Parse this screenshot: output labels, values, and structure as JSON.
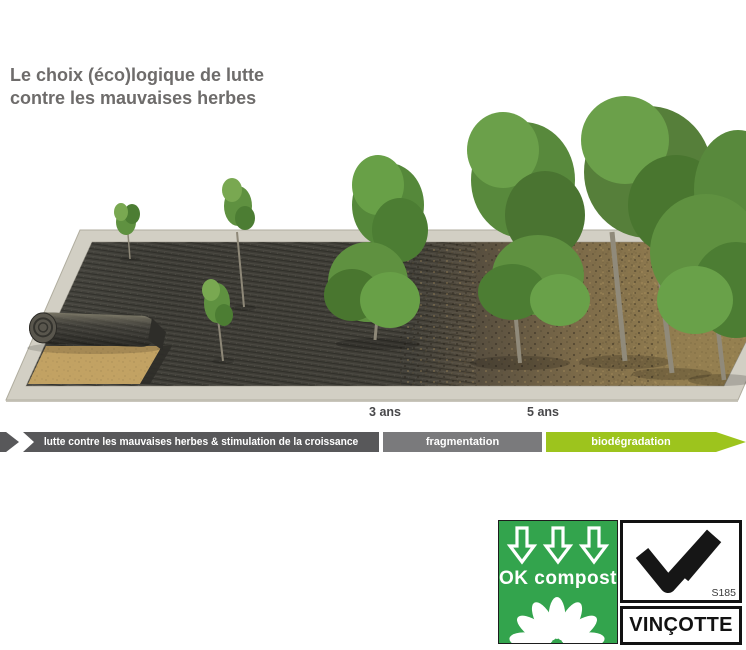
{
  "title": {
    "line1": "Le choix (éco)logique de lutte",
    "line2": "contre les mauvaises herbes",
    "color": "#6e6c6b"
  },
  "timeline": {
    "year_labels": [
      {
        "text": "3 ans"
      },
      {
        "text": "5 ans"
      }
    ],
    "segments": [
      {
        "label": "lutte contre les mauvaises herbes & stimulation de la croissance",
        "color": "#58585a"
      },
      {
        "label": "fragmentation",
        "color": "#7a7a7c"
      },
      {
        "label": "biodégradation",
        "color": "#9dc41d"
      }
    ],
    "text_color": "#ffffff"
  },
  "illustration": {
    "description": "Perspective garden bed: roll of black biodegradable weed-control mat partially unrolled over sandy soil at left, intact mat with young seedlings, mat fragmenting into the soil, bare brown soil with mature shrubs and trees at right",
    "colors": {
      "mat": "#3e3d37",
      "bare_soil": "#97824f",
      "sand": "#c2a263",
      "concrete_border": "#d2cfc4",
      "foliage": "#5f9140"
    }
  },
  "certifications": {
    "ok_compost": {
      "label": "OK compost",
      "background_color": "#33a44d",
      "icons": [
        "down-arrow-icon",
        "down-arrow-icon",
        "down-arrow-icon",
        "daisy-flower-icon"
      ]
    },
    "vincotte": {
      "brand": "VINÇOTTE",
      "certificate_number": "S185",
      "icons": [
        "check-v-icon"
      ]
    }
  }
}
